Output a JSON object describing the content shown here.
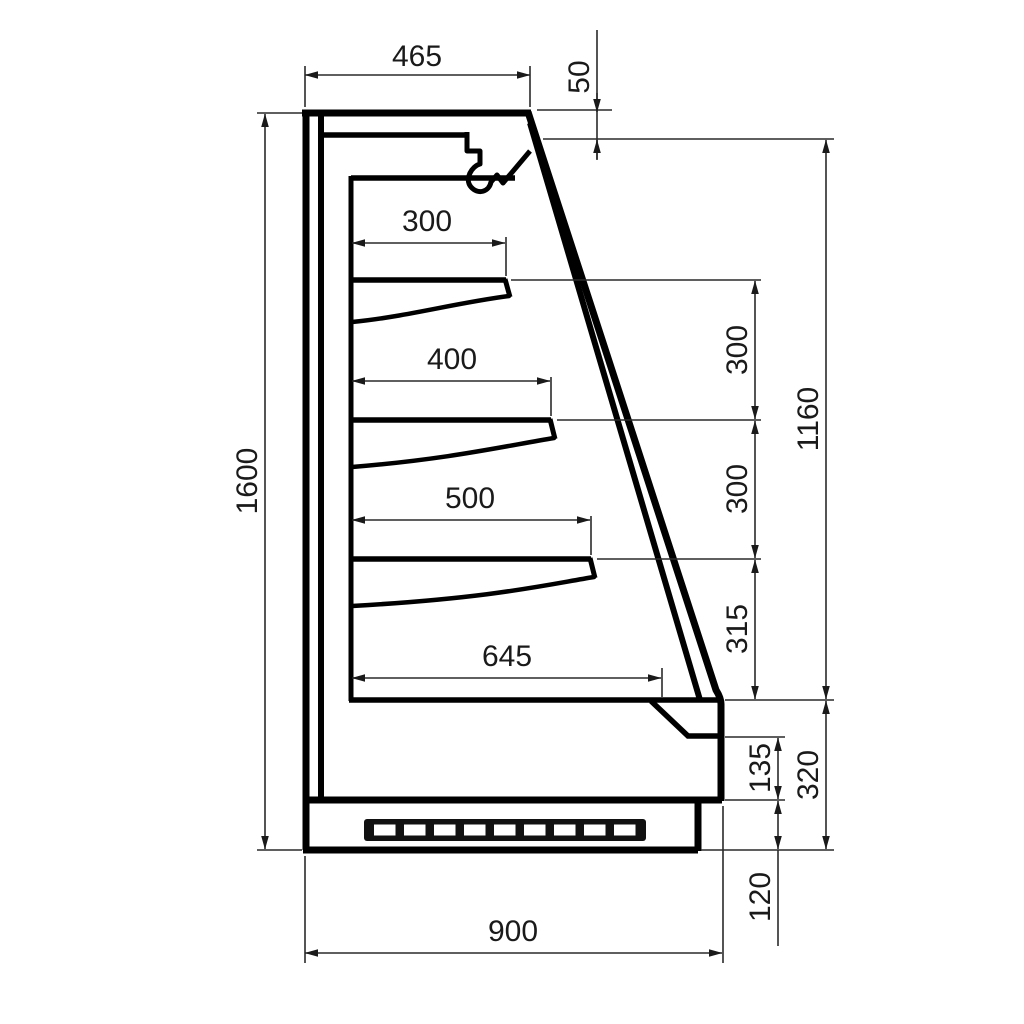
{
  "drawing": {
    "type": "technical-section-drawing",
    "background": "#ffffff",
    "line_color": "#000000",
    "text_color": "#1a1a1a",
    "labels": {
      "top_width": "465",
      "top_front_drop": "50",
      "shelf1_depth": "300",
      "shelf2_depth": "400",
      "shelf3_depth": "500",
      "base_shelf_depth": "645",
      "overall_height": "1600",
      "shelf_spacing_1": "300",
      "shelf_spacing_2": "300",
      "shelf_spacing_3": "315",
      "front_opening_height": "1160",
      "base_section_height": "320",
      "front_panel_height": "135",
      "plinth_height": "120",
      "overall_depth": "900"
    }
  }
}
